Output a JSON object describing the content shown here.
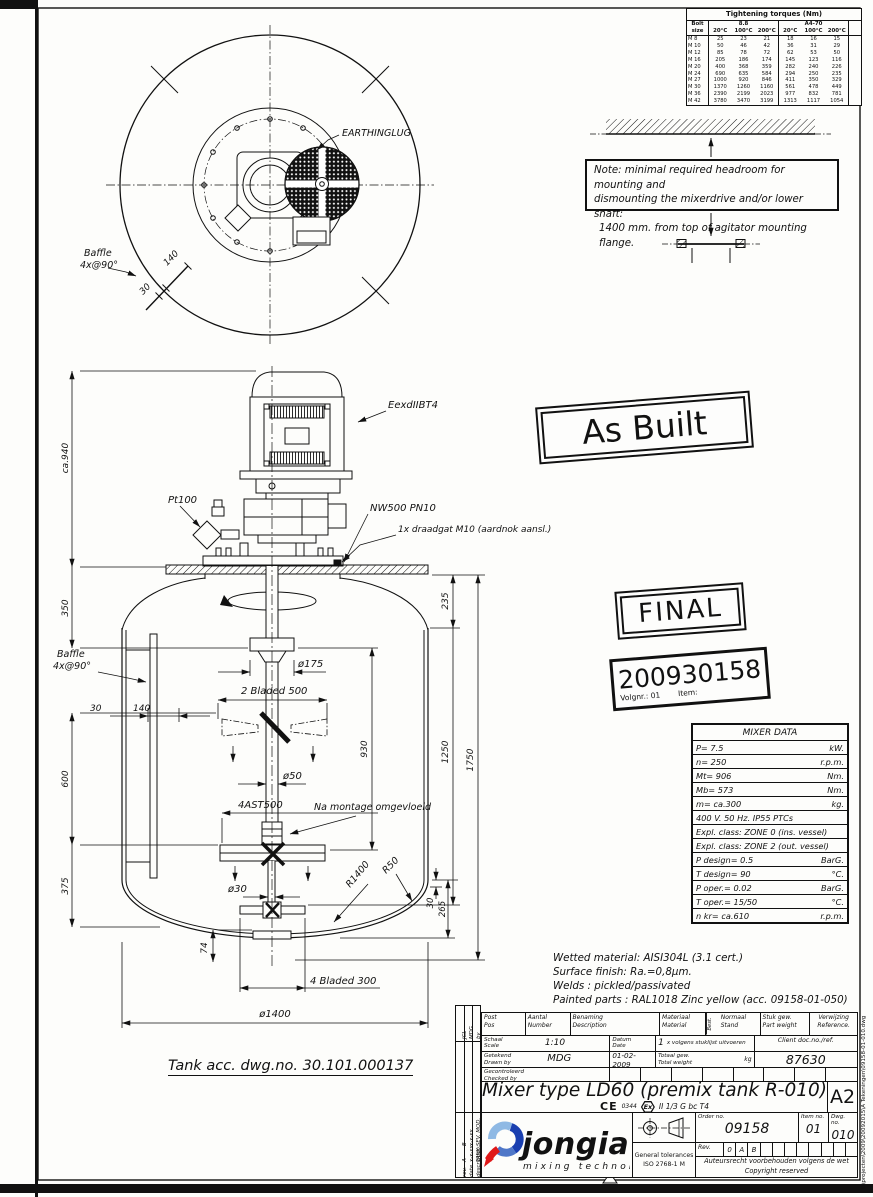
{
  "drawing_labels": {
    "earthinglug": "EARTHINGLUG",
    "baffle1": "Baffle",
    "baffle2": "4x@90°",
    "d140": "140",
    "d30": "30",
    "eexd": "EexdIIBT4",
    "pt100": "Pt100",
    "nw500": "NW500 PN10",
    "draadgat": "1x draadgat M10 (aardnok aansl.)",
    "ca940": "ca.940",
    "d350": "350",
    "d235": "235",
    "d930": "930",
    "d1250": "1250",
    "d1750": "1750",
    "d600": "600",
    "d375": "375",
    "d175": "ø175",
    "bladed2": "2 Bladed 500",
    "d50": "ø50",
    "ast": "4AST500",
    "na_montage": "Na montage omgevloeid",
    "d30shaft": "ø30",
    "r1400": "R1400",
    "r50": "R50",
    "d30r": "30",
    "d265": "265",
    "d74": "74",
    "bladed4": "4 Bladed 300",
    "d1400": "ø1400",
    "tank_acc": "Tank acc. dwg.no. 30.101.000137"
  },
  "torque_table": {
    "title": "Tightening torques (Nm)",
    "bolt_col1": "Bolt",
    "bolt_col2": "size",
    "group1": "8.8",
    "group2": "A4-70",
    "temps": [
      "20°C",
      "100°C",
      "200°C",
      "20°C",
      "100°C",
      "200°C"
    ],
    "rows": [
      {
        "size": "M 8",
        "values": [
          "25",
          "23",
          "21",
          "18",
          "16",
          "15"
        ]
      },
      {
        "size": "M 10",
        "values": [
          "50",
          "46",
          "42",
          "36",
          "31",
          "29"
        ]
      },
      {
        "size": "M 12",
        "values": [
          "85",
          "78",
          "72",
          "62",
          "53",
          "50"
        ]
      },
      {
        "size": "M 16",
        "values": [
          "205",
          "186",
          "174",
          "145",
          "123",
          "116"
        ]
      },
      {
        "size": "M 20",
        "values": [
          "400",
          "368",
          "359",
          "282",
          "240",
          "226"
        ]
      },
      {
        "size": "M 24",
        "values": [
          "690",
          "635",
          "584",
          "294",
          "250",
          "235"
        ]
      },
      {
        "size": "M 27",
        "values": [
          "1000",
          "920",
          "846",
          "411",
          "350",
          "329"
        ]
      },
      {
        "size": "M 30",
        "values": [
          "1370",
          "1260",
          "1160",
          "561",
          "478",
          "449"
        ]
      },
      {
        "size": "M 36",
        "values": [
          "2390",
          "2199",
          "2023",
          "977",
          "832",
          "781"
        ]
      },
      {
        "size": "M 42",
        "values": [
          "3780",
          "3470",
          "3199",
          "1313",
          "1117",
          "1054"
        ]
      }
    ]
  },
  "note_box": {
    "line1": "Note: minimal required headroom for mounting and",
    "line2": "dismounting the mixerdrive and/or lower shaft:",
    "line3": "1400 mm. from top of agitator mounting flange."
  },
  "stamps": {
    "as_built": "As Built",
    "final": "FINAL",
    "number": "200930158",
    "volgnr": "Volgnr.: 01",
    "item": "Item:"
  },
  "mixer_data": {
    "title": "MIXER DATA",
    "rows": [
      {
        "label": "P= 7.5",
        "unit": "kW."
      },
      {
        "label": "n= 250",
        "unit": "r.p.m."
      },
      {
        "label": "Mt= 906",
        "unit": "Nm."
      },
      {
        "label": "Mb= 573",
        "unit": "Nm."
      },
      {
        "label": "m= ca.300",
        "unit": "kg."
      },
      {
        "label": "400 V.  50 Hz. IP55 PTCs",
        "unit": ""
      },
      {
        "label": "Expl. class: ZONE 0 (ins. vessel)",
        "unit": ""
      },
      {
        "label": "Expl. class: ZONE 2 (out. vessel)",
        "unit": ""
      },
      {
        "label": "P design= 0.5",
        "unit": "BarG."
      },
      {
        "label": "T design= 90",
        "unit": "°C."
      },
      {
        "label": "P oper.= 0.02",
        "unit": "BarG."
      },
      {
        "label": "T oper.= 15/50",
        "unit": "°C."
      },
      {
        "label": "n kr= ca.610",
        "unit": "r.p.m."
      }
    ]
  },
  "material_notes": {
    "lines": [
      "Wetted material: AISI304L (3.1 cert.)",
      "Surface finish: Ra.=0,8µm.",
      "Welds : pickled/passivated",
      "Painted parts : RAL1018 Zinc yellow (acc. 09158-01-050)"
    ]
  },
  "title_block": {
    "h_post1": "Post",
    "h_post2": "Pos",
    "h_aantal1": "Aantal",
    "h_aantal2": "Number",
    "h_ben1": "Benaming",
    "h_ben2": "Description",
    "h_mat1": "Materiaal",
    "h_mat2": "Material",
    "h_best": "Best.",
    "h_norm1": "Normaal",
    "h_norm2": "Stand",
    "h_stuk1": "Stuk gew.",
    "h_stuk2": "Part weight",
    "h_verw1": "Verwijzing",
    "h_verw2": "Reference.",
    "schaal": "Schaal",
    "scale": "Scale",
    "scale_value": "1:10",
    "datum": "Datum",
    "date": "Date",
    "date_value": "01-02-2009",
    "qty": "1",
    "uitvoeren": "x volgens stuklijst uitvoeren",
    "client_label": "Client doc.no./ref.",
    "client_value": "87630",
    "getekend": "Getekend",
    "drawn_by": "Drawn by",
    "drawn_value": "MDG",
    "totaal": "Totaal gew.",
    "total": "Total weight",
    "kg": "kg",
    "gecontroleerd": "Gecontroleerd",
    "checked_by": "Checked by",
    "title": "Mixer type LD60 (premix tank R-010)",
    "ce": "CE",
    "ce_num": "0344",
    "ex": "Ex",
    "atex": "II 1/3 G bc T4",
    "sheet": "A2",
    "logo_text": "jongia",
    "logo_tagline": "mixing technology",
    "logo_blue": "#2323c8",
    "logo_red": "#e01818",
    "logo_lightblue": "#8fb9e4",
    "tol1": "General tolerances",
    "tol2": "ISO 2768-1 M",
    "order_label": "Order no.",
    "order_value": "09158",
    "item_label": "Item no.",
    "item_value": "01",
    "dwg_label": "Dwg. no.",
    "dwg_value": "010",
    "rev_label": "Rev.",
    "revs": [
      "0",
      "A",
      "B"
    ],
    "copy1": "Auteursrecht voorbehouden volgens de wet",
    "copy2": "Copyright reserved"
  },
  "rev_strip": {
    "by1": "JCL",
    "by2": "MDG",
    "by_h": "by",
    "rows": [
      {
        "rev": "B",
        "date": "x-x-xx",
        "desc": "SEV. MOD."
      },
      {
        "rev": "A",
        "date": "x-x-xx",
        "desc": "TANK"
      }
    ],
    "h_rev": "rev.",
    "h_date": "date",
    "h_desc": "description:"
  },
  "edge": {
    "file_path": "K:\\projecten\\2009\\20092015\\A Tekeningen\\09158-01-010.dwg"
  }
}
